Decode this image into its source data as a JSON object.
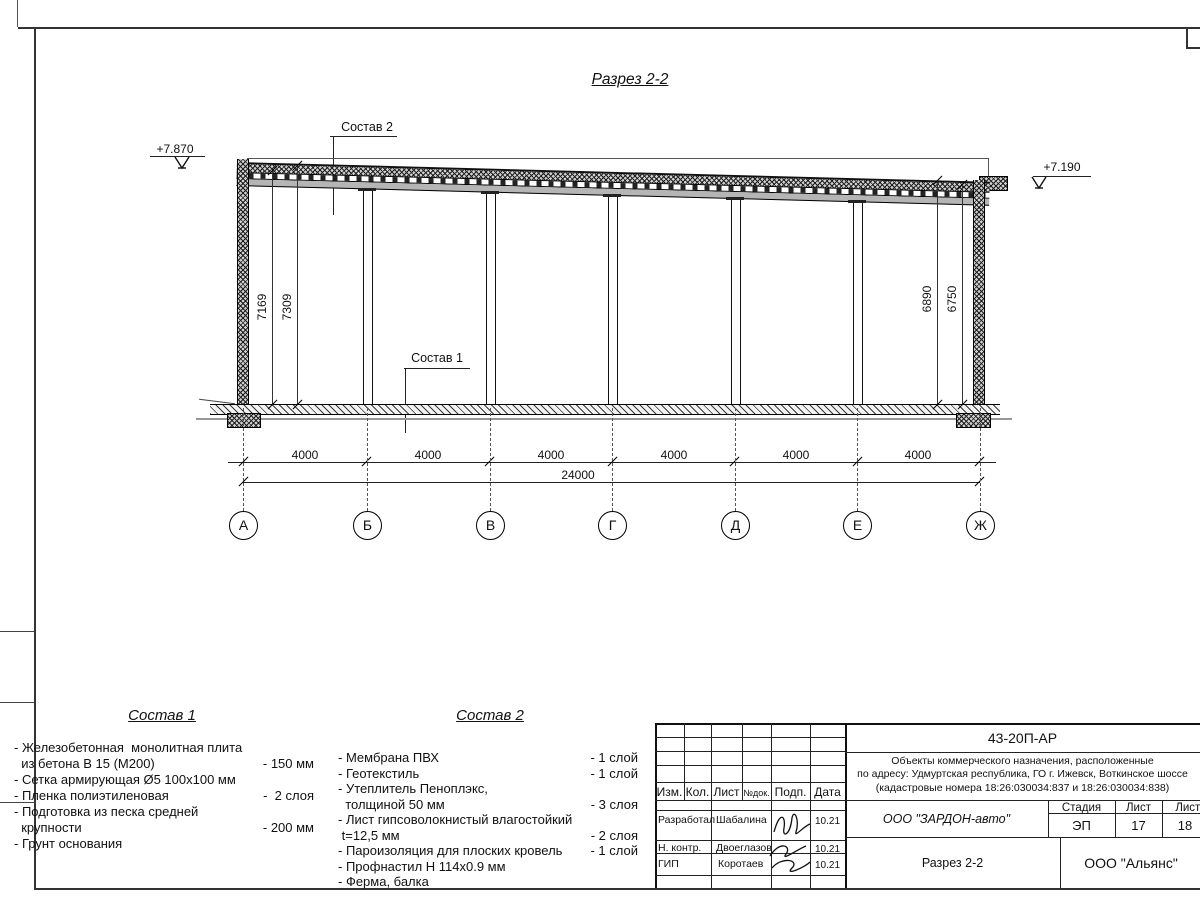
{
  "drawing": {
    "title": "Разрез 2-2",
    "elevation_left": "+7.870",
    "elevation_right": "+7.190",
    "sostav1_label": "Состав 1",
    "sostav2_label": "Состав 2",
    "dims_left": [
      "7169",
      "7309"
    ],
    "dims_right": [
      "6890",
      "6750"
    ],
    "bay_dims": [
      "4000",
      "4000",
      "4000",
      "4000",
      "4000",
      "4000"
    ],
    "total_dim": "24000",
    "axes": [
      "А",
      "Б",
      "В",
      "Г",
      "Д",
      "Е",
      "Ж"
    ]
  },
  "materials1": {
    "heading": "Состав 1",
    "rows": [
      {
        "t": "- Железобетонная  монолитная плита",
        "v": ""
      },
      {
        "t": "  из бетона В 15 (М200)",
        "v": "- 150 мм"
      },
      {
        "t": "- Сетка армирующая Ø5 100x100 мм",
        "v": ""
      },
      {
        "t": "- Пленка полиэтиленовая",
        "v": "-  2 слоя"
      },
      {
        "t": "- Подготовка из песка средней",
        "v": ""
      },
      {
        "t": "  крупности",
        "v": "- 200 мм"
      },
      {
        "t": "- Грунт основания",
        "v": ""
      }
    ]
  },
  "materials2": {
    "heading": "Состав 2",
    "rows": [
      {
        "t": "- Мембрана ПВХ",
        "v": "- 1 слой"
      },
      {
        "t": "- Геотекстиль",
        "v": "- 1 слой"
      },
      {
        "t": "- Утеплитель Пеноплэкс,",
        "v": ""
      },
      {
        "t": "  толщиной 50 мм",
        "v": "- 3 слоя"
      },
      {
        "t": "- Лист гипсоволокнистый влагостойкий",
        "v": ""
      },
      {
        "t": " t=12,5 мм",
        "v": "- 2 слоя"
      },
      {
        "t": "- Пароизоляция для плоских кровель",
        "v": "- 1 слой"
      },
      {
        "t": "- Профнастил Н 114x0.9 мм",
        "v": ""
      },
      {
        "t": "- Ферма, балка",
        "v": ""
      }
    ]
  },
  "titleblock": {
    "doc_code": "43-20П-АР",
    "description_line1": "Объекты коммерческого назначения, расположенные",
    "description_line2": "по адресу: Удмуртская республика, ГО г. Ижевск, Воткинское шоссе",
    "description_line3": "(кадастровые номера 18:26:030034:837 и 18:26:030034:838)",
    "cols": {
      "c1": "Изм.",
      "c2": "Кол.",
      "c3": "Лист",
      "c4": "№док.",
      "c5": "Подп.",
      "c6": "Дата"
    },
    "signers": [
      {
        "role": "Разработал",
        "name": "Шабалина",
        "date": "10.21"
      },
      {
        "role": "Н. контр.",
        "name": "Двоеглазов",
        "date": "10.21"
      },
      {
        "role": "ГИП",
        "name": "Коротаев",
        "date": "10.21"
      }
    ],
    "company": "ООО \"ЗАРДОН-авто\"",
    "sheet_title": "Разрез 2-2",
    "stage_label": "Стадия",
    "sheet_label": "Лист",
    "sheets_label": "Листов",
    "stage": "ЭП",
    "sheet_no": "17",
    "sheets_total": "18",
    "org": "ООО \"Альянс\""
  }
}
